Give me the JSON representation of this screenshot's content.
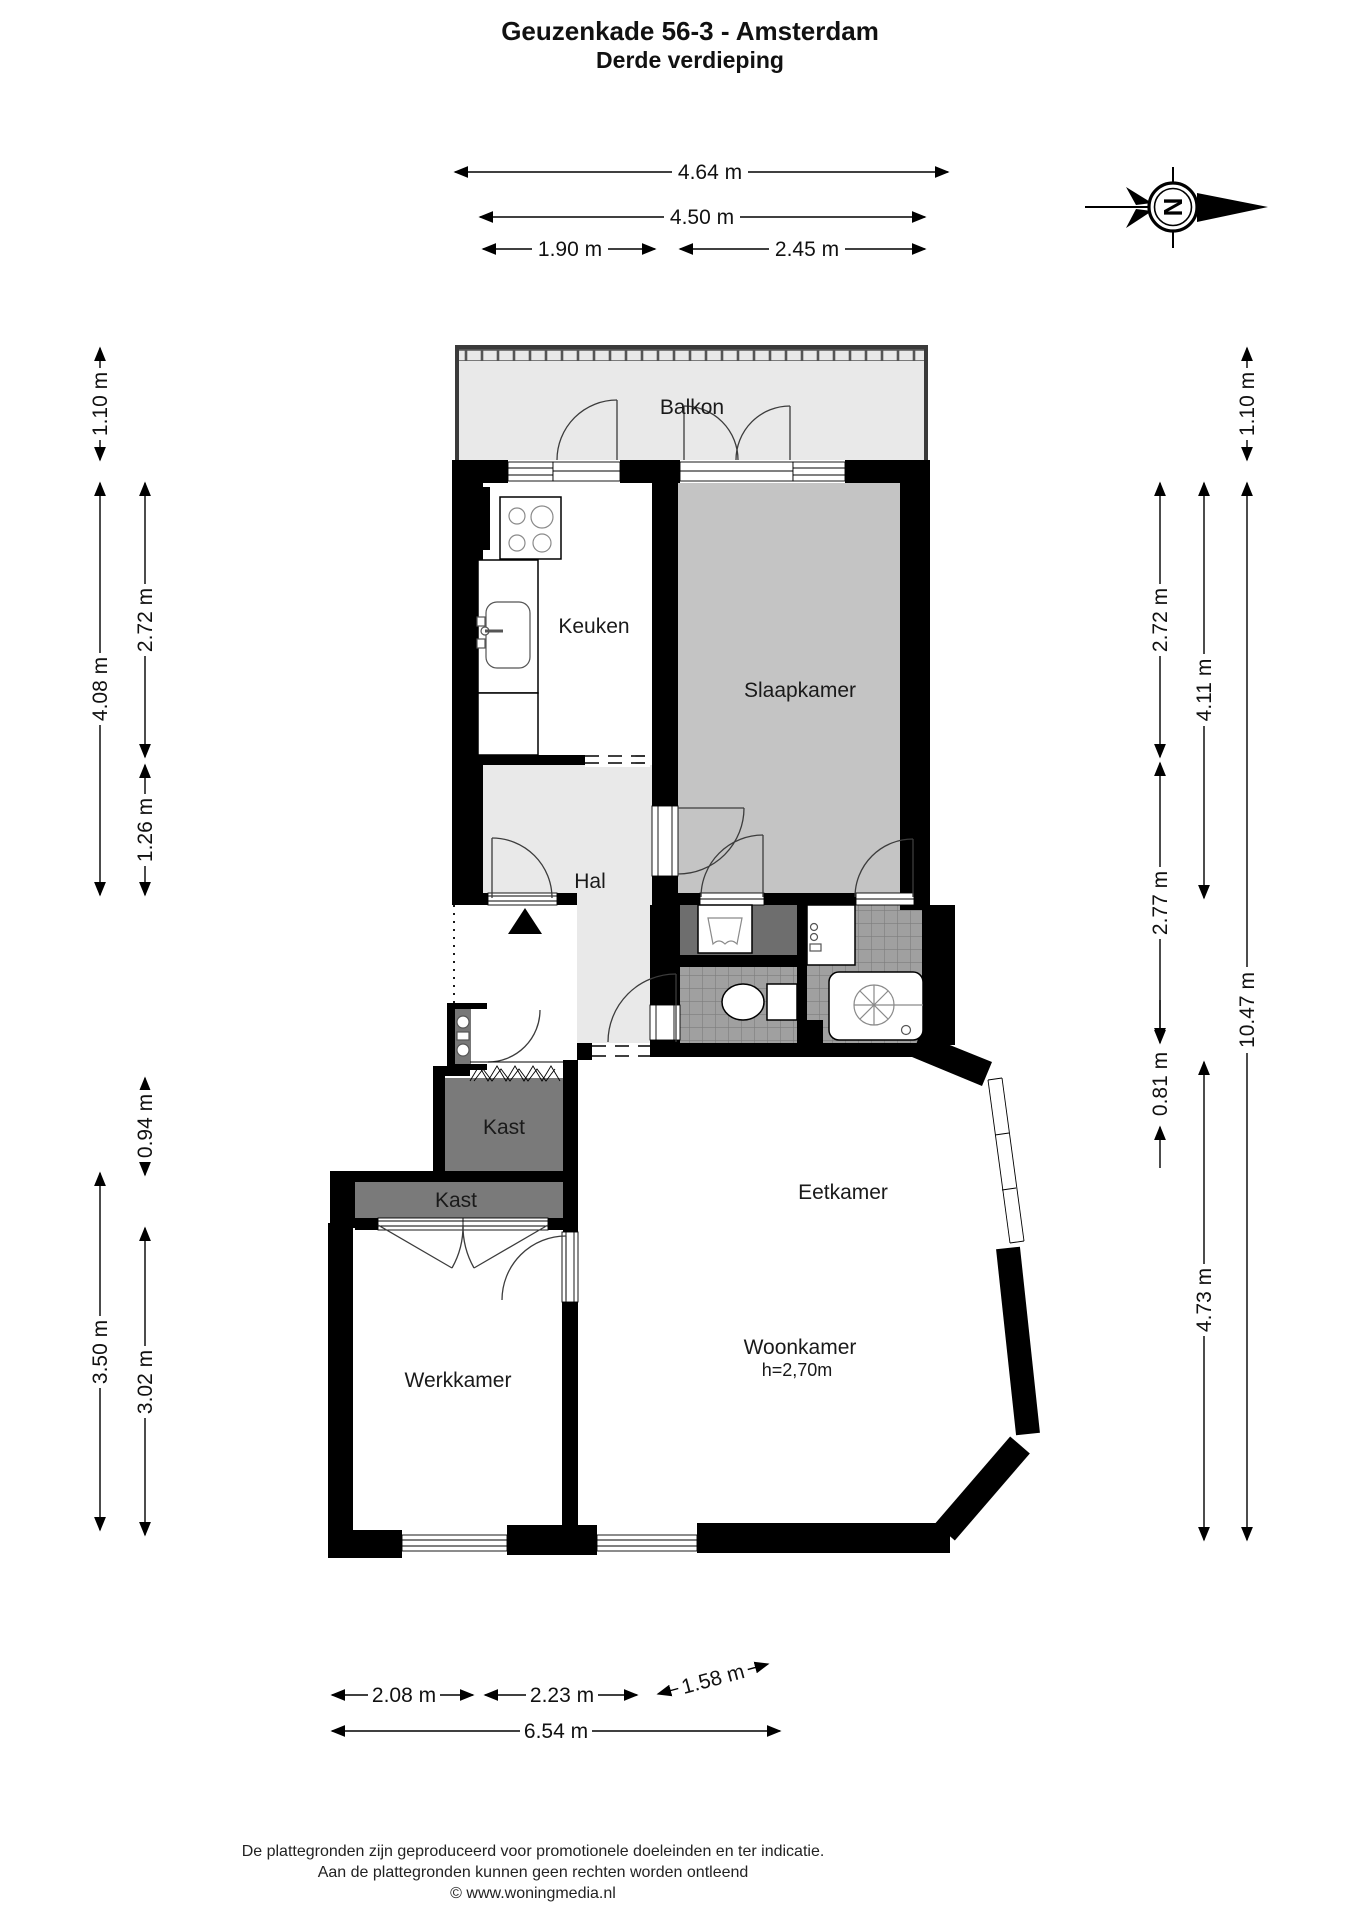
{
  "title": {
    "line1": "Geuzenkade 56-3 - Amsterdam",
    "line2": "Derde verdieping"
  },
  "rooms": {
    "balkon": "Balkon",
    "keuken": "Keuken",
    "slaapkamer": "Slaapkamer",
    "hal": "Hal",
    "kast_boven": "Kast",
    "kast_onder": "Kast",
    "eetkamer": "Eetkamer",
    "woonkamer": "Woonkamer",
    "woonkamer_height": "h=2,70m",
    "werkkamer": "Werkkamer"
  },
  "dimensions": {
    "top": [
      "4.64 m",
      "4.50 m",
      "1.90 m",
      "2.45 m"
    ],
    "left": [
      "1.10 m",
      "2.72 m",
      "4.08 m",
      "1.26 m",
      "0.94 m",
      "3.50 m",
      "3.02 m"
    ],
    "right": [
      "1.10 m",
      "2.72 m",
      "4.11 m",
      "2.77 m",
      "0.81 m",
      "10.47 m",
      "4.73 m"
    ],
    "bottom": [
      "2.08 m",
      "2.23 m",
      "1.58 m",
      "6.54 m"
    ]
  },
  "compass": {
    "north_label": "N"
  },
  "footer": {
    "line1": "De plattegronden zijn geproduceerd voor promotionele doeleinden en ter indicatie.",
    "line2": "Aan de plattegronden kunnen geen rechten worden ontleend",
    "line3": "© www.woningmedia.nl"
  },
  "colors": {
    "wall": "#000000",
    "balkon_fill": "#e9e9e9",
    "hal_fill": "#e9e9e9",
    "slaapkamer_fill": "#c4c4c4",
    "kast_fill": "#7a7a7a",
    "niche_fill": "#6e6e6e",
    "tile_fill": "#a0a0a0",
    "duct_fill": "#555555"
  }
}
